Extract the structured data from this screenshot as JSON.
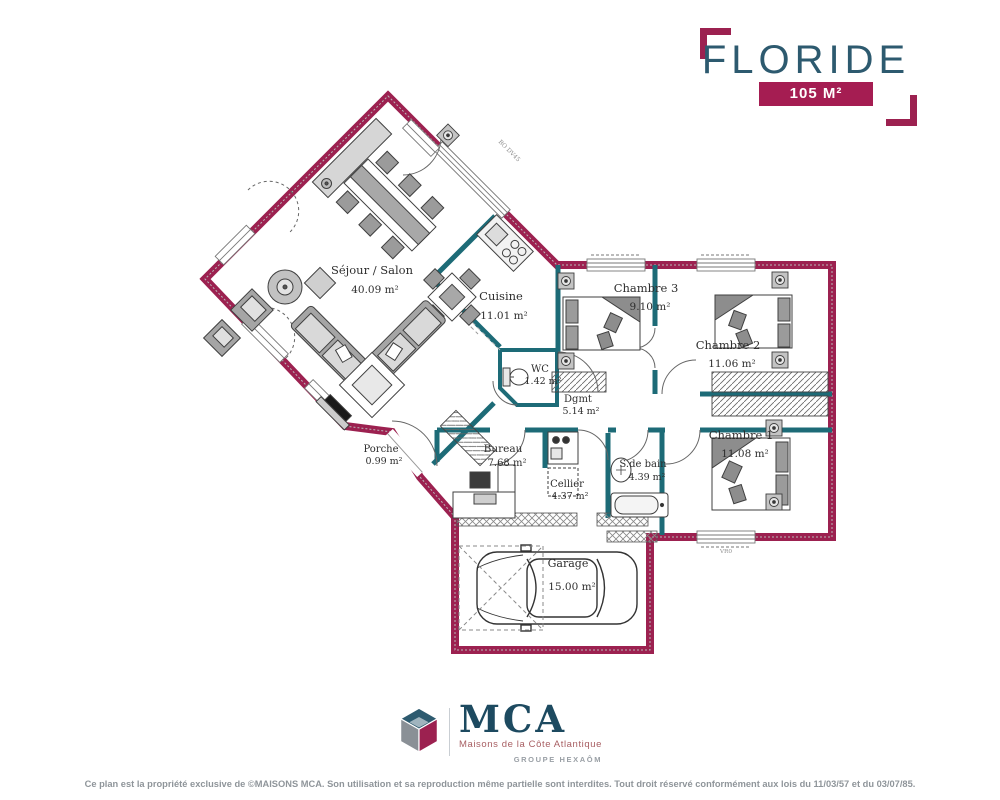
{
  "title_block": {
    "title": "FLORIDE",
    "area_badge": "105 M²"
  },
  "plan": {
    "rooms": [
      {
        "name": "Séjour / Salon",
        "area": "40.09 m²"
      },
      {
        "name": "Cuisine",
        "area": "11.01 m²"
      },
      {
        "name": "Chambre 3",
        "area": "9.10 m²"
      },
      {
        "name": "Chambre 2",
        "area": "11.06 m²"
      },
      {
        "name": "Chambre 1",
        "area": "11.08 m²"
      },
      {
        "name": "WC",
        "area": "1.42 m²"
      },
      {
        "name": "Dgmt",
        "area": "5.14 m²"
      },
      {
        "name": "Bureau",
        "area": "7.68 m²"
      },
      {
        "name": "Cellier",
        "area": "4.37 m²"
      },
      {
        "name": "S.de bain",
        "area": "4.39 m²"
      },
      {
        "name": "Porche",
        "area": "0.99 m²"
      },
      {
        "name": "Garage",
        "area": "15.00 m²"
      }
    ],
    "annotations": {
      "window_label": "BO DV45",
      "shutter_label": "VR0"
    }
  },
  "logo": {
    "acronym": "MCA",
    "company": "Maisons de la Côte Atlantique",
    "group": "GROUPE HEXAÔM"
  },
  "footer": {
    "copyright": "Ce plan est la propriété exclusive de ©MAISONS MCA. Son utilisation et sa reproduction même partielle sont interdites. Tout droit réservé conformément aux lois du 11/03/57 et du 03/07/85."
  },
  "colors": {
    "exterior_wall": "#9c2150",
    "interior_wall": "#1d6b77",
    "title": "#2d5a6f",
    "badge_bg": "#a51d52",
    "logo_navy": "#1d4a60",
    "logo_red": "#a85f63"
  }
}
